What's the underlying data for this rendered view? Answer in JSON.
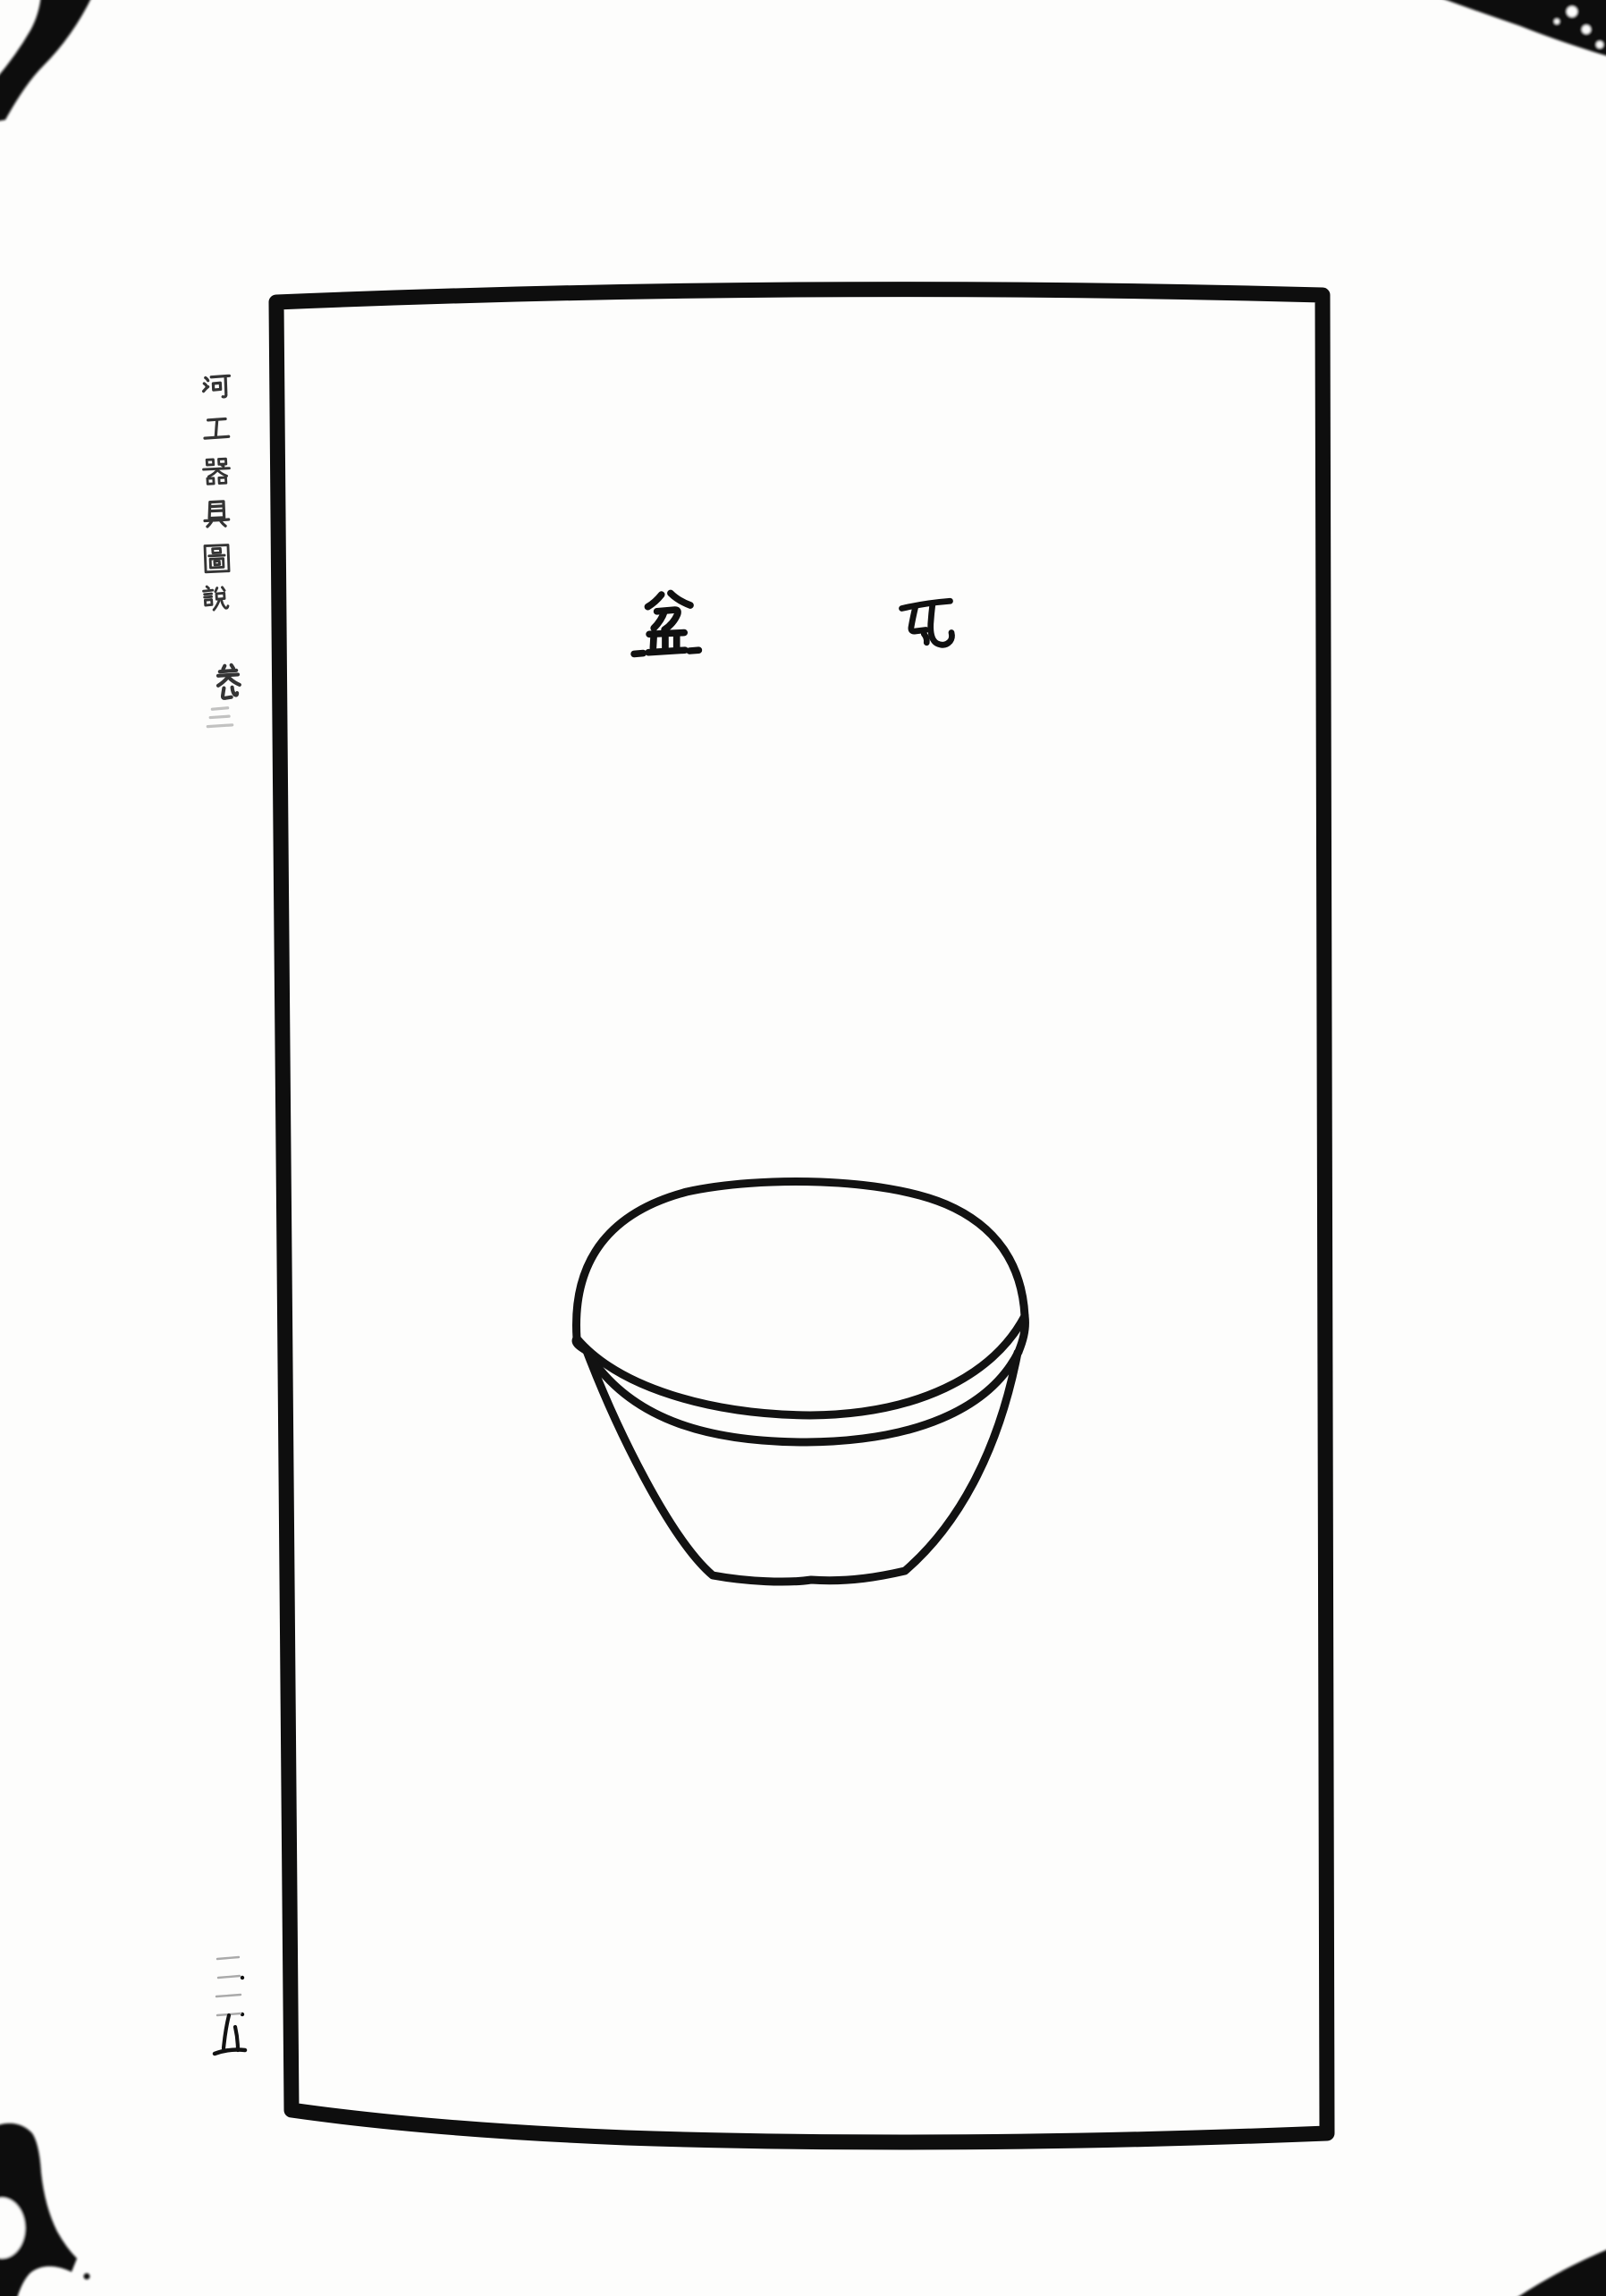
{
  "colors": {
    "paper": "#fdfdfc",
    "ink": "#141414",
    "faint_ink": "#aaaaaa"
  },
  "plate_title": {
    "text": "瓦盆",
    "reading_order": "right-to-left",
    "characters": [
      "瓦",
      "盆"
    ]
  },
  "illustration": {
    "subject": "瓦盆",
    "description": "hand-drawn earthenware basin: domed top, double-line rim band, tapered body with flat base"
  },
  "side_title": {
    "text": "河工器具圖說",
    "volume": "卷三",
    "characters": [
      "河",
      "工",
      "器",
      "具",
      "圖",
      "說"
    ],
    "volume_characters": [
      "卷",
      "三"
    ]
  },
  "page_number": {
    "text": "一二五",
    "value": 125,
    "characters": [
      "一",
      "二",
      "五"
    ]
  }
}
